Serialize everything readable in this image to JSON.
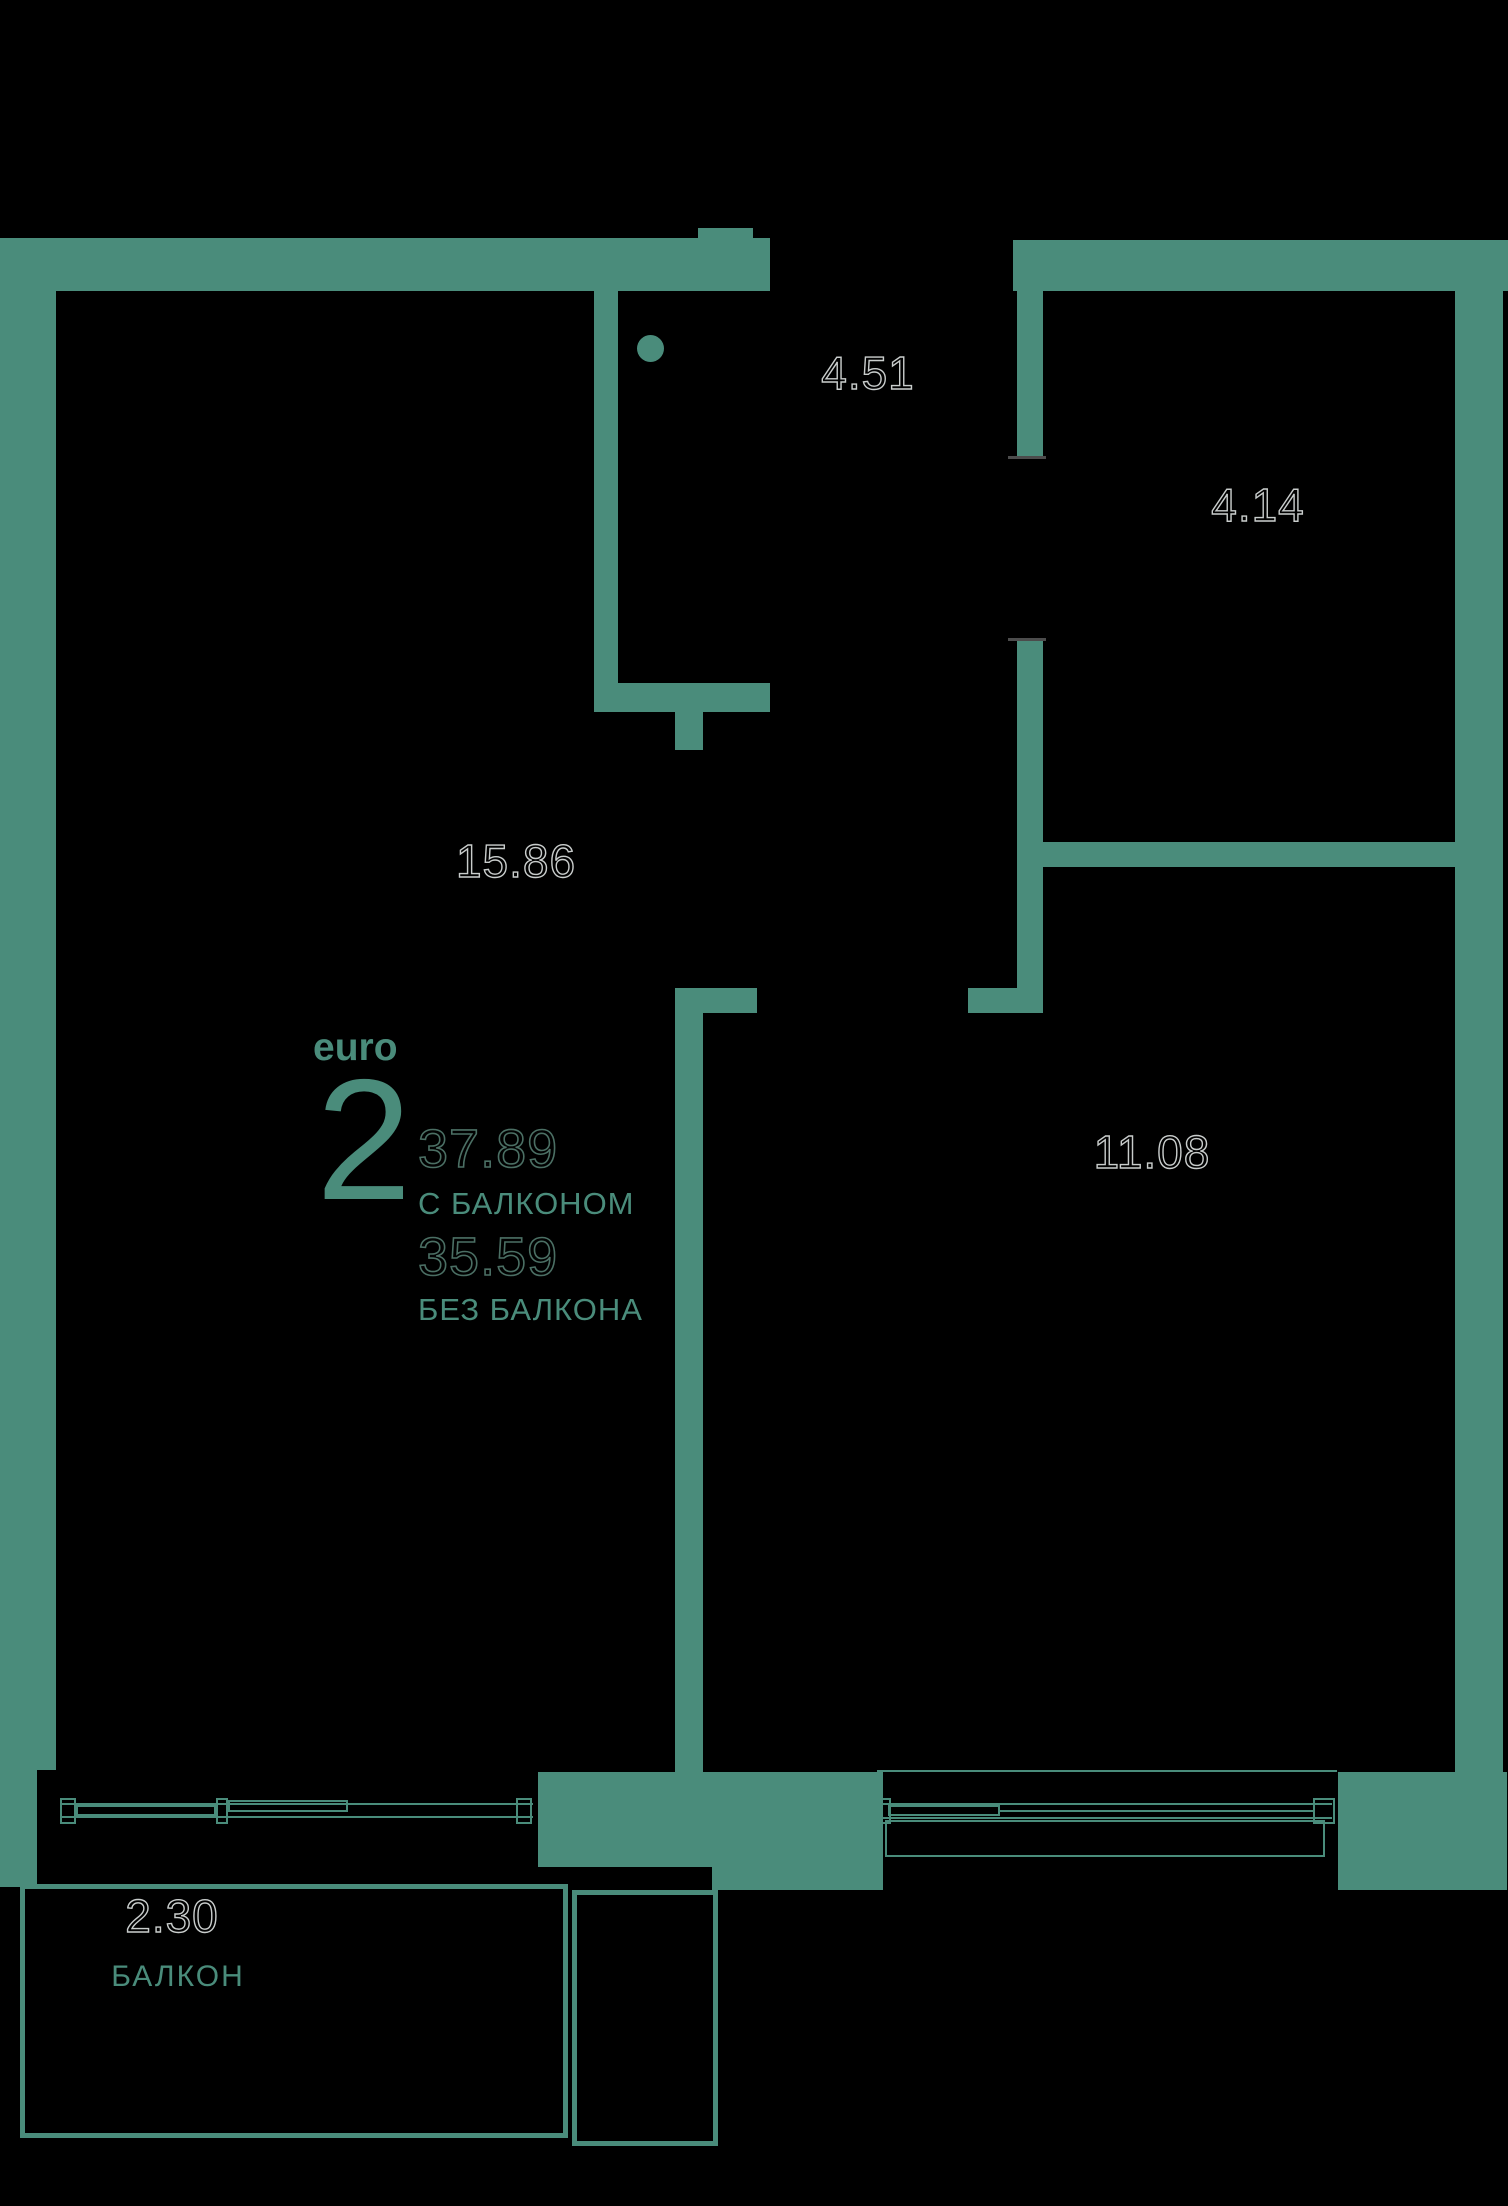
{
  "plan": {
    "unit_type_label": "euro",
    "unit_rooms": "2",
    "area_with_balcony": "37.89",
    "label_with_balcony": "С БАЛКОНОМ",
    "area_without_balcony": "35.59",
    "label_without_balcony": "БЕЗ БАЛКОНА",
    "rooms": [
      {
        "name": "living-kitchen",
        "area": "15.86"
      },
      {
        "name": "hallway",
        "area": "4.51"
      },
      {
        "name": "room-top-right",
        "area": "4.14"
      },
      {
        "name": "bedroom",
        "area": "11.08"
      },
      {
        "name": "balcony",
        "area": "2.30",
        "label": "БАЛКОН"
      }
    ]
  },
  "colors": {
    "wall": "#4a8c7b",
    "background": "#000000",
    "area_outline": "#c9cdcc",
    "value_outline": "#4b6f64"
  }
}
